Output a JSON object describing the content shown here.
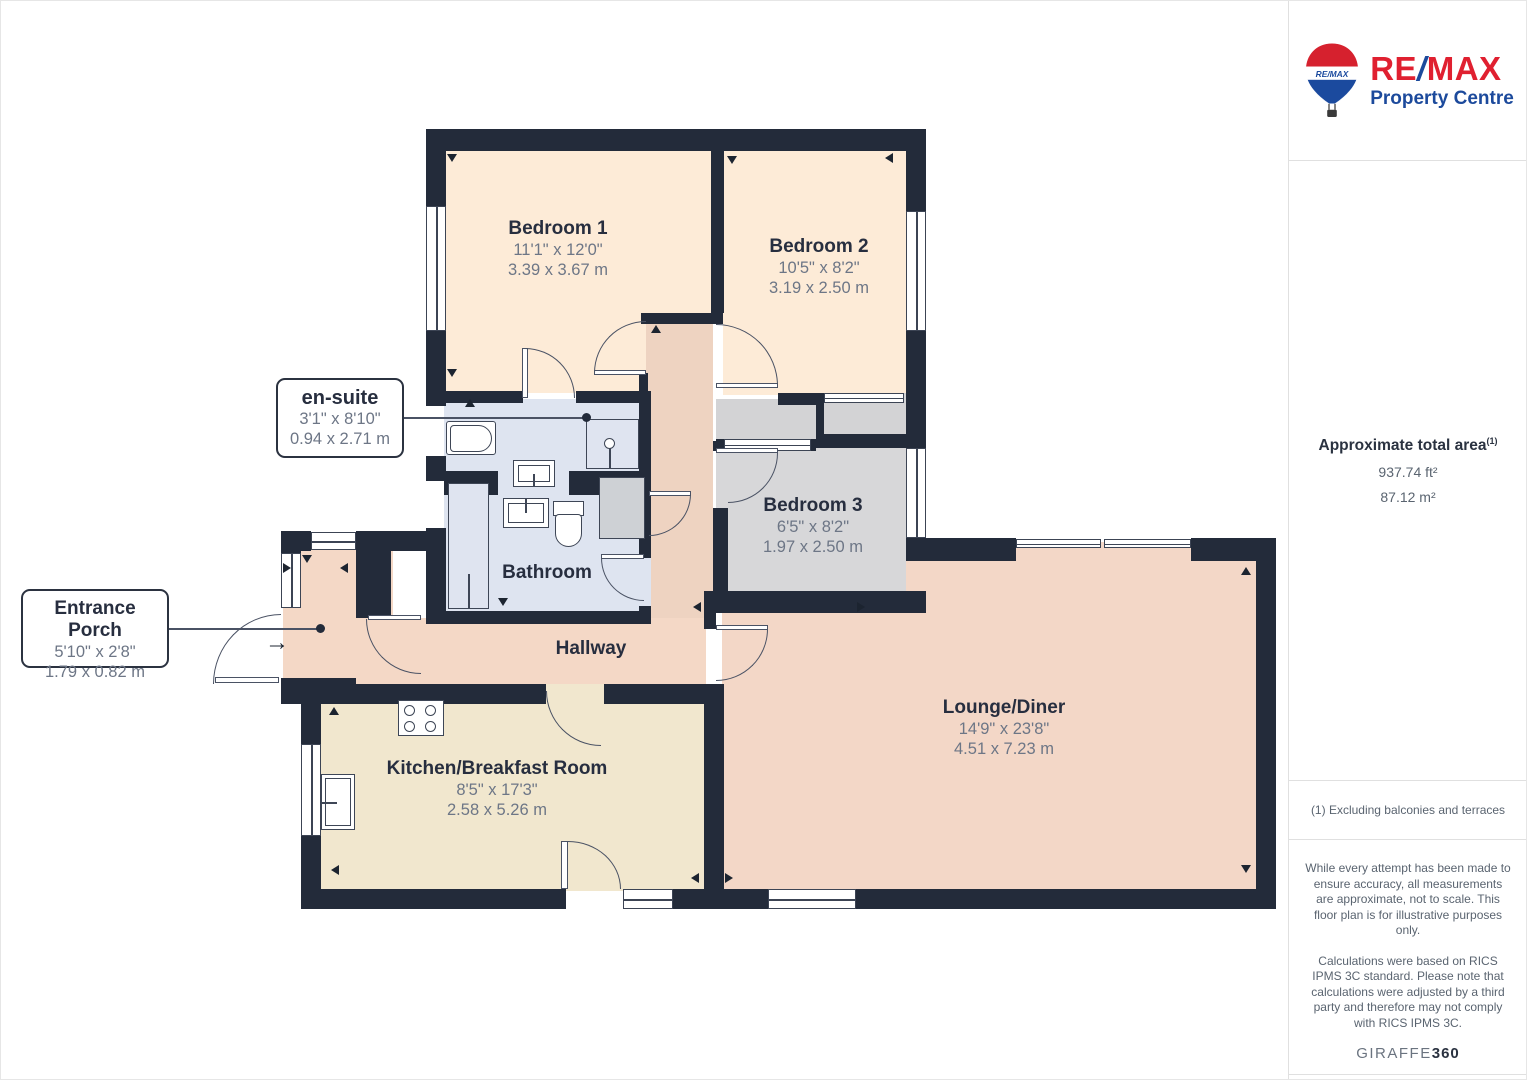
{
  "rooms": {
    "bedroom1": {
      "name": "Bedroom 1",
      "imperial": "11'1\" x 12'0\"",
      "metric": "3.39 x 3.67 m"
    },
    "bedroom2": {
      "name": "Bedroom 2",
      "imperial": "10'5\" x 8'2\"",
      "metric": "3.19 x 2.50 m"
    },
    "bedroom3": {
      "name": "Bedroom 3",
      "imperial": "6'5\" x 8'2\"",
      "metric": "1.97 x 2.50 m"
    },
    "ensuite": {
      "name": "en-suite",
      "imperial": "3'1\" x 8'10\"",
      "metric": "0.94 x 2.71 m"
    },
    "bathroom": {
      "name": "Bathroom"
    },
    "hallway": {
      "name": "Hallway"
    },
    "porch": {
      "name": "Entrance Porch",
      "imperial": "5'10\" x 2'8\"",
      "metric": "1.79 x 0.82 m"
    },
    "kitchen": {
      "name": "Kitchen/Breakfast Room",
      "imperial": "8'5\" x 17'3\"",
      "metric": "2.58 x 5.26 m"
    },
    "lounge": {
      "name": "Lounge/Diner",
      "imperial": "14'9\" x 23'8\"",
      "metric": "4.51 x 7.23 m"
    }
  },
  "icons": {
    "entry_arrow": "→"
  },
  "sidebar": {
    "brand": {
      "balloon_text": "RE/MAX",
      "wordmark_re": "RE",
      "wordmark_slash": "/",
      "wordmark_max": "MAX",
      "tagline": "Property Centre",
      "red": "#e02030",
      "blue": "#1c4a9c"
    },
    "area": {
      "title": "Approximate total area",
      "sup": "(1)",
      "imperial": "937.74 ft²",
      "metric": "87.12 m²"
    },
    "footnote": "(1) Excluding balconies and terraces",
    "disclaimer_1": "While every attempt has been made to ensure accuracy, all measurements are approximate, not to scale. This floor plan is for illustrative purposes only.",
    "disclaimer_2": "Calculations were based on RICS IPMS 3C standard. Please note that calculations were adjusted by a third party and therefore may not comply with RICS IPMS 3C.",
    "credit_name": "GIRAFFE",
    "credit_suffix": "360"
  }
}
